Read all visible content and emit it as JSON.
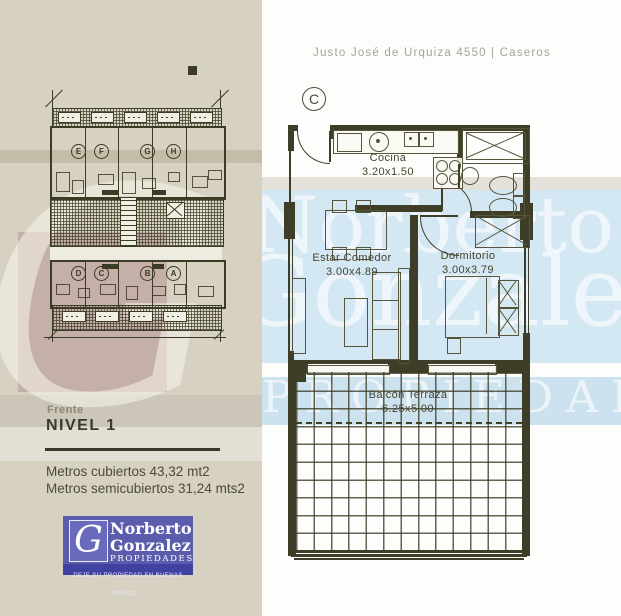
{
  "address": "Justo José de Urquiza 4550  | Caseros",
  "unit": {
    "label": "C"
  },
  "plan": {
    "rooms": [
      {
        "name": "Cocina",
        "dims": "3.20x1.50"
      },
      {
        "name": "Estar Comedor",
        "dims": "3.00x4.89"
      },
      {
        "name": "Dormitorio",
        "dims": "3.00x3.79"
      },
      {
        "name": "Balcón Terraza",
        "dims": "6.25x5.00"
      }
    ]
  },
  "overview": {
    "top_units": [
      "E",
      "F",
      "G",
      "H"
    ],
    "bottom_units": [
      "D",
      "C",
      "B",
      "A"
    ]
  },
  "info": {
    "orientation": "Frente",
    "level": "NIVEL 1",
    "area_lines": [
      "Metros cubiertos 43,32 mt2",
      "Metros semicubiertos 31,24 mts2"
    ]
  },
  "logo": {
    "initial": "G",
    "name_line1": "Norberto",
    "name_line2": "Gonzalez",
    "subtitle": "PROPIEDADES",
    "tagline": "DEJE SU PROPIEDAD EN BUENAS MANOS..."
  },
  "watermark": {
    "initial": "G",
    "line1": "Norberto",
    "line2": "Gonzalez",
    "line3": "PROPIEDADES"
  },
  "colors": {
    "plan_line": "#3e3d27",
    "beige_strip": "#d7d1c2",
    "mauve_overlay": "#9a6570",
    "blue_band": "#d4e8f4",
    "logo_blue": "#5c5cac",
    "logo_blue_dark": "#4141a2"
  }
}
